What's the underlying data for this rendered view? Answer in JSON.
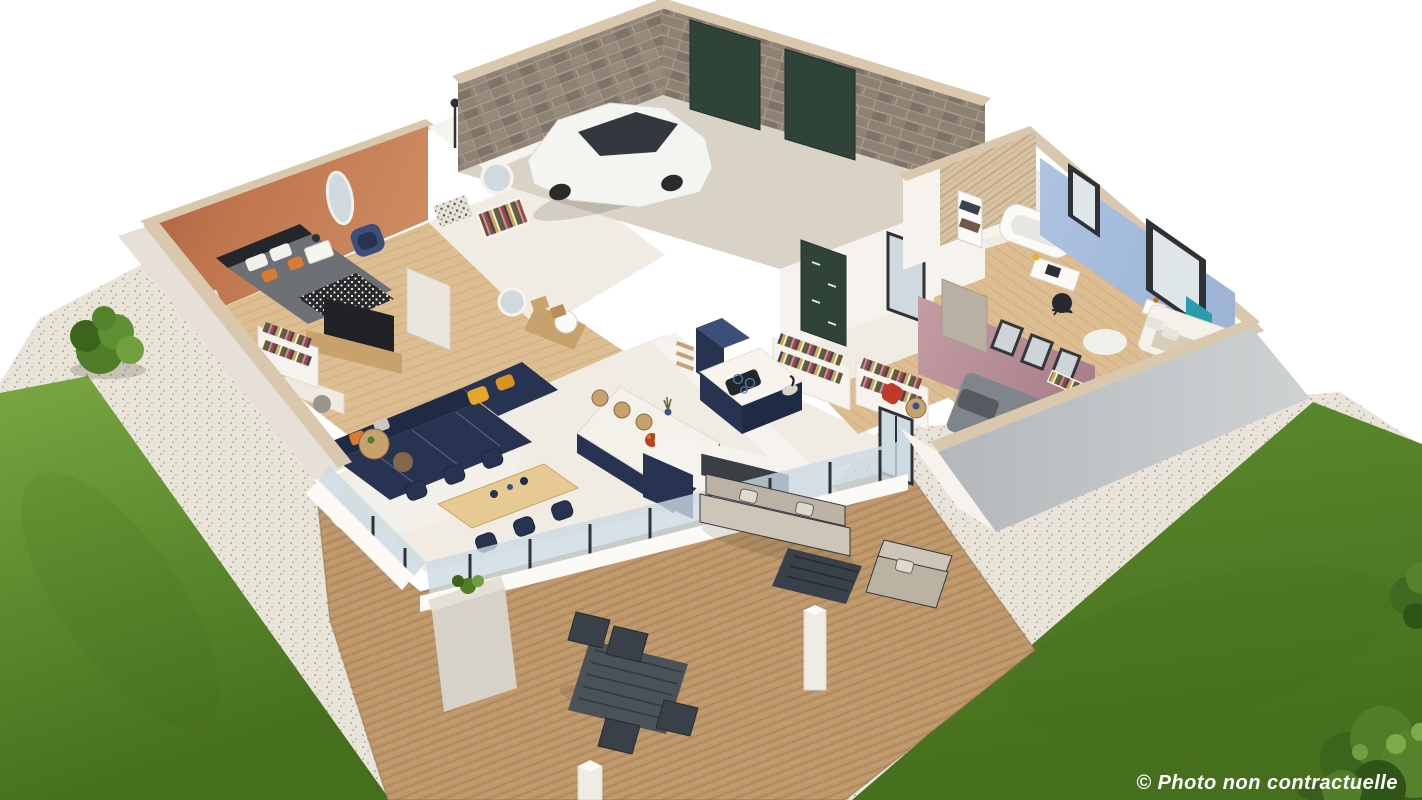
{
  "watermark": {
    "text": "© Photo non contractuelle"
  },
  "palette": {
    "bg": "#ffffff",
    "grass_light": "#7aa742",
    "grass_mid": "#5d8a2e",
    "grass_dark": "#456e1d",
    "gravel": "#e9e4da",
    "gravel_dot": "#bdb09d",
    "deck_wood": "#bd9769",
    "deck_line": "#99754e",
    "wall_white": "#f6f3ee",
    "wall_shade": "#e6e0d8",
    "wall_cap": "#d9c8ad",
    "wall_gray": "#b4b8bb",
    "wall_gray_light": "#cfd2d3",
    "terracotta": "#c0754e",
    "blue_wall": "#aec3e1",
    "pink_wall": "#c49da4",
    "pink_wall_dark": "#a97f8a",
    "brick": "#8e8275",
    "brick_dark": "#75675b",
    "mortar": "#a79b8d",
    "garage_door_green": "#2f4339",
    "garage_floor": "#d9d2c6",
    "tile_floor": "#f0ece4",
    "wood_floor": "#ddbe92",
    "wood_mid": "#c8a26d",
    "wood_dark": "#8a6a46",
    "navy": "#273350",
    "navy_dark": "#1f2a44",
    "navy_light": "#3c4f78",
    "yellow_pillow": "#e8a42b",
    "orange_pillow": "#dc7a30",
    "outdoor_beige": "#bcb2a3",
    "outdoor_beige_light": "#cec5b9",
    "outdoor_frame": "#34383d",
    "dark_frame": "#2e3236",
    "glass_tint": "#ccdae2",
    "car_white": "#f4f4f1",
    "car_glass": "#33373e",
    "accent_red": "#c0392b",
    "accent_teal": "#2a9dab",
    "bush_dark": "#3c641c",
    "bush_mid": "#4f7d28",
    "bush_light": "#6f9f3f",
    "watermark_white": "#ffffff"
  }
}
